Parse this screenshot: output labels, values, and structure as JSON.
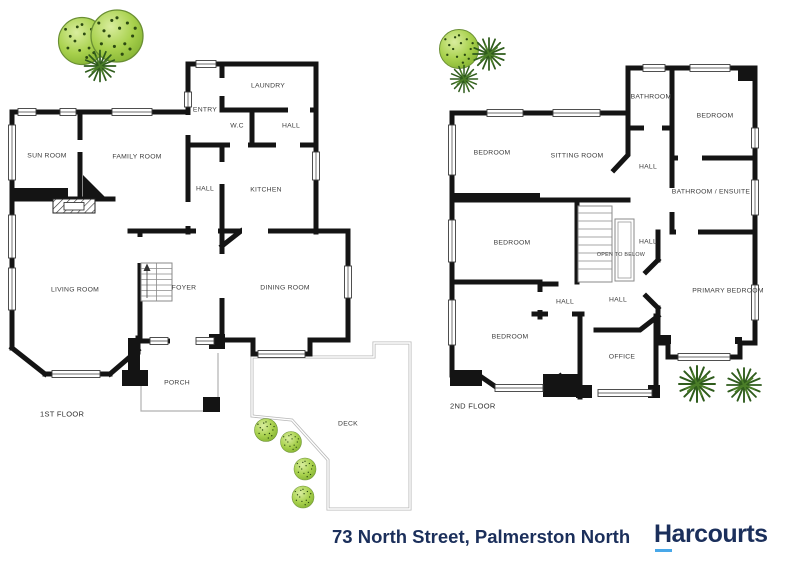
{
  "floor1": {
    "label": "1ST FLOOR",
    "rooms": {
      "sun_room": "SUN ROOM",
      "family_room": "FAMILY ROOM",
      "laundry": "LAUNDRY",
      "entry": "ENTRY",
      "wc": "W.C",
      "hall_upper": "HALL",
      "hall": "HALL",
      "kitchen": "KITCHEN",
      "living_room": "LIVING ROOM",
      "foyer": "FOYER",
      "dining_room": "DINING ROOM",
      "porch": "PORCH",
      "deck": "DECK"
    }
  },
  "floor2": {
    "label": "2ND FLOOR",
    "rooms": {
      "bedroom_top_left": "BEDROOM",
      "sitting_room": "SITTING ROOM",
      "bathroom": "BATHROOM",
      "bedroom_top_right": "BEDROOM",
      "hall_top": "HALL",
      "bathroom_ensuite": "BATHROOM / ENSUITE",
      "bedroom_mid": "BEDROOM",
      "open_to_below": "OPEN TO BELOW",
      "hall_stair": "HALL",
      "hall_small": "HALL",
      "hall_lower": "HALL",
      "primary_bedroom": "PRIMARY BEDROOM",
      "bedroom_bottom": "BEDROOM",
      "office": "OFFICE"
    }
  },
  "footer": {
    "address": "73 North Street, Palmerston North",
    "brand": "Harcourts"
  },
  "colors": {
    "wall": "#141414",
    "label_text": "#3d3d3d",
    "navy": "#1b2f5b",
    "brand_underline": "#49a8e9",
    "tree_light": "#a8d14d",
    "tree_dark": "#2f5c1c"
  }
}
